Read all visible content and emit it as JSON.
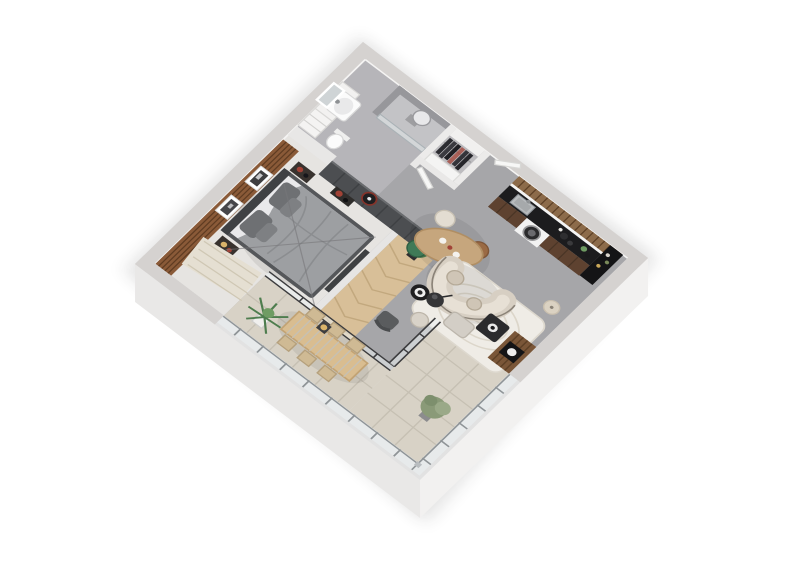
{
  "canvas": {
    "width": 800,
    "height": 566
  },
  "scene": {
    "title": "3D isometric floor plan render — studio apartment with balcony",
    "view": "axonometric dollhouse cutaway, white background",
    "rooms": [
      {
        "id": "bathroom",
        "label": "Bathroom",
        "items": [
          "vanity cabinet with white sink",
          "wall mirror",
          "tall storage cabinet",
          "toilet",
          "walk-in shower with glass panel and gray tray",
          "rain shower head"
        ]
      },
      {
        "id": "wardrobe",
        "label": "Open wardrobe nook",
        "items": [
          "white closet carcass",
          "rail with dark hanging clothes",
          "low shelf unit"
        ]
      },
      {
        "id": "entry",
        "label": "Entry hall",
        "items": [
          "open white door leaves",
          "concrete floor"
        ]
      },
      {
        "id": "kitchen",
        "label": "Kitchen along north-east wall",
        "items": [
          "walnut upper cabinets",
          "walnut base cabinets",
          "black countertop",
          "steel sink",
          "washing machine with round door",
          "black coffee/appliance column",
          "counter bottles"
        ]
      },
      {
        "id": "living",
        "label": "Living / dining open space",
        "items": [
          "oval wood dining table",
          "cream chair",
          "caramel chair",
          "two green velvet chairs",
          "curved cream sofa with bolster cushions",
          "black round side table",
          "white wavy-pattern rug",
          "gray ottoman bench",
          "wood-slat media / fireplace column",
          "black floor lamp",
          "beige floor lamp",
          "dark gray armchair",
          "hall plant"
        ]
      },
      {
        "id": "bedroom",
        "label": "Bedroom",
        "items": [
          "walnut slat accent wall",
          "two framed pictures",
          "double bed with gray duvet",
          "dark pillows",
          "dark headboard",
          "two dark nightstands with red vase decor",
          "dark gray closet wall with round wall fan",
          "foot bench",
          "cream fringe rug",
          "glazed sliding wall to balcony"
        ]
      },
      {
        "id": "balcony",
        "label": "Wrap-around balcony terrace",
        "items": [
          "large beige floor tiles",
          "slatted wood dining table",
          "six slatted chairs",
          "candle lantern",
          "palm plant in white pot",
          "olive shrub in pot",
          "glass railing with posts"
        ]
      }
    ]
  },
  "colors": {
    "pageBg": "#ffffff",
    "shadow": "#1a1a1a",
    "wallTop": "#d5d2d0",
    "wallFaceSW": "#e9e8e7",
    "wallFaceSE": "#f2f1f0",
    "wallWhite": "#eceaе9",
    "floorConcrete": "#a6a6a9",
    "floorBedroom": "#e6e4e1",
    "floorBathroom": "#b6b5b9",
    "floorNook": "#bdbcbf",
    "hallWood": "#d8bf98",
    "hallWoodLine": "#c2a87e",
    "tileBalcony": "#d8d2c6",
    "tileGrout": "#c6c0b3",
    "woodAccent": "#8a5a38",
    "woodAccentDark": "#5f3c22",
    "closetWall": "#4c4e51",
    "closetPanel": "#3e4043",
    "bedFrame": "#55575a",
    "bedDuvet": "#9d9fa2",
    "bedSheet": "#e9e9eb",
    "pillowDark": "#6e7073",
    "headboard": "#3f4144",
    "nightstand": "#38322e",
    "vaseRed": "#a14236",
    "rugBedroom": "#e5dfd2",
    "kitchenWoodTop": "#8c6b4a",
    "kitchenWoodFront": "#5e4230",
    "counterBlack": "#1c1c1e",
    "steel": "#b9bcbe",
    "washerWhite": "#f2f2f2",
    "washerDoor": "#2a2a2c",
    "diningWood": "#c6a67d",
    "chairCream": "#e3ddd2",
    "chairGreen": "#3f7a57",
    "chairBrown": "#9a6a44",
    "sofaBody": "#d7cfc3",
    "sofaLight": "#e7e0d5",
    "rugWhite": "#efece6",
    "rugLine": "#dcd6ca",
    "coffeeTable": "#2b2b2d",
    "ottoman": "#d3cec6",
    "mediaWood": "#7a5638",
    "mediaWoodDark": "#5d4026",
    "lampBlack": "#353537",
    "lampBeige": "#dbd2c2",
    "armchairGray": "#5a5c5e",
    "plantGreen": "#4e7d4e",
    "plantGreenLight": "#6f9c63",
    "plantOlive": "#8a9a78",
    "plantOliveLight": "#9aa988",
    "terraceTable": "#d9bd90",
    "terraceChair": "#cfba94",
    "lanternBody": "#3e3e40",
    "lanternGlow": "#d9b36a",
    "glass": "rgba(235,240,243,0.55)",
    "railPost": "#8f9497",
    "frameDark": "#3c3c3e",
    "mirror": "#cfd4d6",
    "showerWall": "#97979b",
    "showerTray": "#c3c3c6",
    "doorLeaf": "#f7f7f6"
  }
}
